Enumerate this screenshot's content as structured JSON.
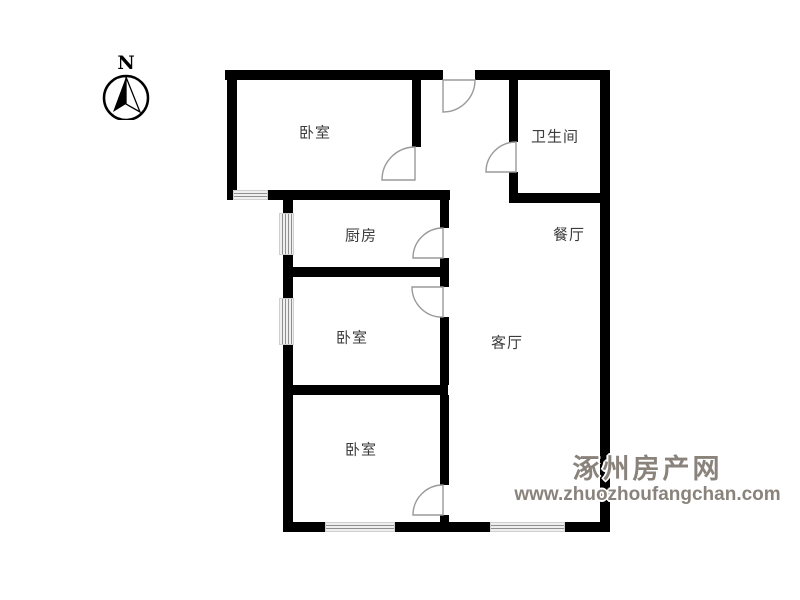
{
  "compass": {
    "north_label": "N"
  },
  "rooms": {
    "bedroom_top": {
      "label": "卧室"
    },
    "bathroom": {
      "label": "卫生间"
    },
    "kitchen": {
      "label": "厨房"
    },
    "dining": {
      "label": "餐厅"
    },
    "bedroom_middle": {
      "label": "卧室"
    },
    "living": {
      "label": "客厅"
    },
    "bedroom_bottom": {
      "label": "卧室"
    }
  },
  "watermark": {
    "site_name": "涿州房产网",
    "site_url": "www.zhuozhoufangchan.com",
    "text_color": "#8a837c"
  },
  "colors": {
    "wall": "#000000",
    "door_arc": "#9a9a9a",
    "window_line": "#8f8f8f",
    "room_label": "#3c3c3c",
    "background": "#ffffff"
  }
}
